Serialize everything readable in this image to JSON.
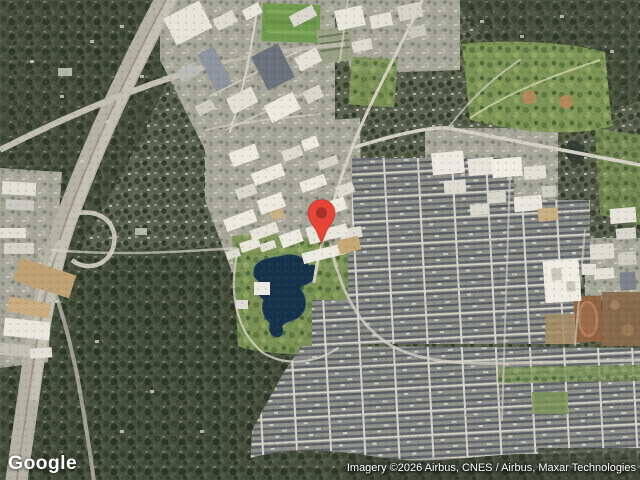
{
  "map": {
    "view": "satellite",
    "pin": {
      "color": "#E64437",
      "inner_color": "#A6332A"
    }
  },
  "branding": {
    "logo_text": "Google"
  },
  "attribution": {
    "text": "Imagery ©2026 Airbus, CNES / Airbus, Maxar Technologies"
  },
  "palette": {
    "water": "#16324A",
    "forest": "#49523E",
    "suburb_trees": "#5D644F",
    "residential_roofs": "#8F918B",
    "roads": "#D4D1C4",
    "field_green": "#6F9A4D",
    "dirt_brown": "#8F6344",
    "building_white": "#ECEAE0"
  }
}
